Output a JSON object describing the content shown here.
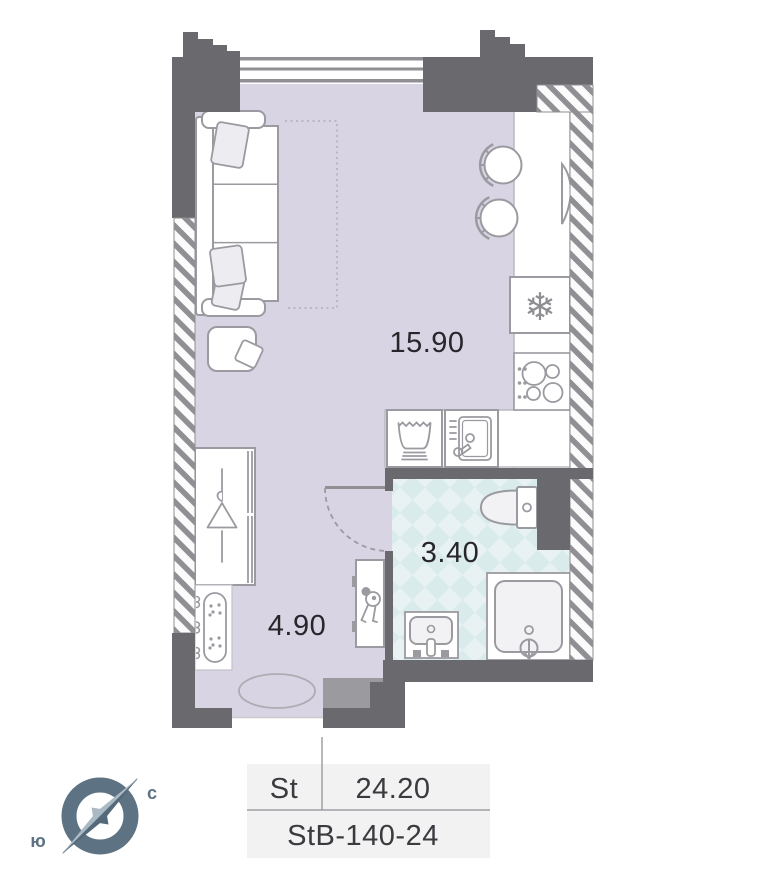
{
  "plan": {
    "living_area_label": "15.90",
    "bathroom_area_label": "3.40",
    "hallway_area_label": "4.90"
  },
  "legend": {
    "plan_type": "St",
    "total_area": "24.20",
    "unit_code": "StB-140-24"
  },
  "compass": {
    "north_label": "с",
    "south_label": "ю"
  },
  "icons": {
    "fridge_glyph": "❄",
    "fridge": "snowflake-icon",
    "wardrobe": "hanger-icon",
    "key_cabinet": "keys-icon"
  },
  "colors": {
    "floor": "#D8D4E3",
    "bathroom_tile_bg": "#E8F2F2",
    "bathroom_tile_diamond": "#D9EBEB",
    "wall_dark": "#6A6A6E",
    "wall_medium": "#9B9B9F",
    "hatch_stripe": "#8F8F94",
    "fixture_outline": "#9A9AA0",
    "fixture_fill_soft": "#F2F2F4",
    "text_dark": "#26262B",
    "legend_bg": "#F2F2F2",
    "legend_line": "#A0A0A4",
    "compass_dark": "#5D7383",
    "compass_light": "#A9BAC5"
  }
}
